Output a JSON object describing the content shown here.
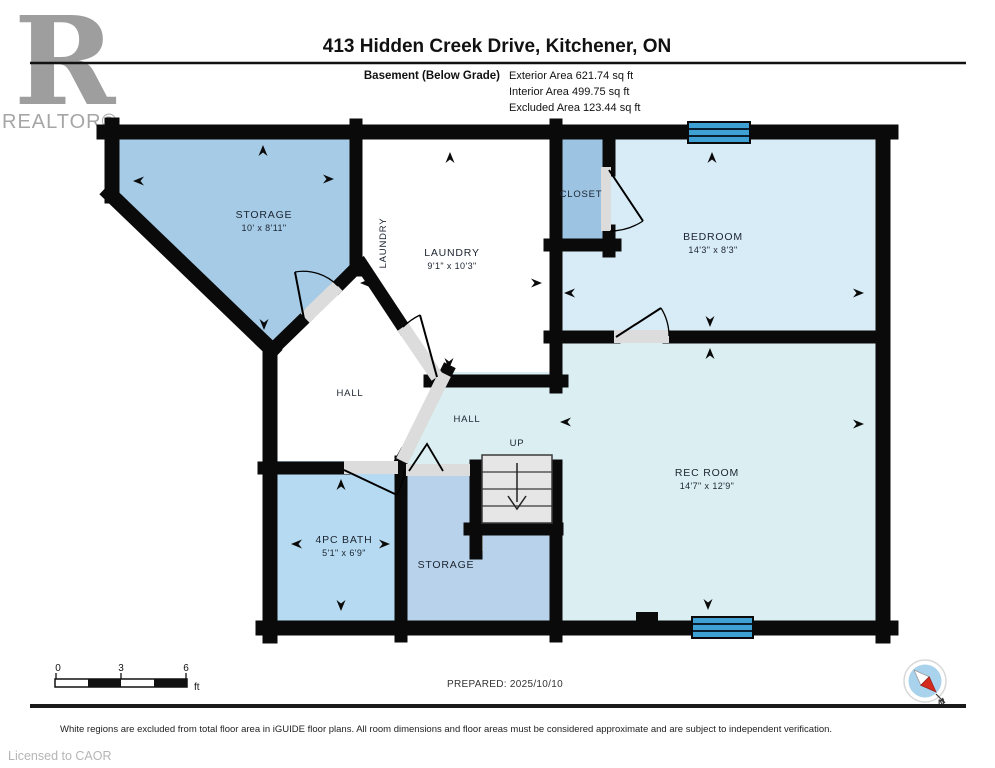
{
  "header": {
    "title": "413 Hidden Creek Drive, Kitchener, ON",
    "floor_label": "Basement (Below Grade)",
    "exterior_area": "Exterior Area 621.74 sq ft",
    "interior_area": "Interior Area 499.75 sq ft",
    "excluded_area": "Excluded Area 123.44 sq ft"
  },
  "logo": {
    "letter": "R",
    "wordmark": "REALTOR®"
  },
  "rooms": {
    "storage_tl": {
      "name": "STORAGE",
      "dims": "10' x 8'11\""
    },
    "laundry": {
      "name": "LAUNDRY",
      "dims": "9'1\" x 10'3\"",
      "side_label": "LAUNDRY"
    },
    "closet": {
      "name": "CLOSET"
    },
    "bedroom": {
      "name": "BEDROOM",
      "dims": "14'3\" x 8'3\""
    },
    "hall_west": {
      "name": "HALL"
    },
    "hall_east": {
      "name": "HALL"
    },
    "stairs": {
      "label": "UP"
    },
    "rec_room": {
      "name": "REC ROOM",
      "dims": "14'7\" x 12'9\""
    },
    "bath": {
      "name": "4PC BATH",
      "dims": "5'1\" x 6'9\""
    },
    "storage_b": {
      "name": "STORAGE"
    }
  },
  "scale_bar": {
    "tick0": "0",
    "tick1": "3",
    "tick2": "6",
    "unit": "ft"
  },
  "compass": {
    "north_label": "N"
  },
  "footer": {
    "prepared": "PREPARED: 2025/10/10",
    "disclaimer": "White regions are excluded from total floor area in iGUIDE floor plans. All room dimensions and floor areas must be considered approximate and are subject to independent verification.",
    "license": "Licensed to CAOR"
  },
  "colors": {
    "room_medium_blue": "#A6CBE7",
    "room_closet_blue": "#9CC4E2",
    "room_light_blue_bedroom": "#D8ECF7",
    "room_light_blue_rec": "#DBEFF2",
    "room_bath_blue": "#B5DAF1",
    "room_storage_b_blue": "#B7D2EA",
    "window_blue": "#3FA0D4",
    "wall_black": "#0a0a0a",
    "opening_gray": "#DCDCDC",
    "stairs_gray": "#E6E6E6"
  }
}
